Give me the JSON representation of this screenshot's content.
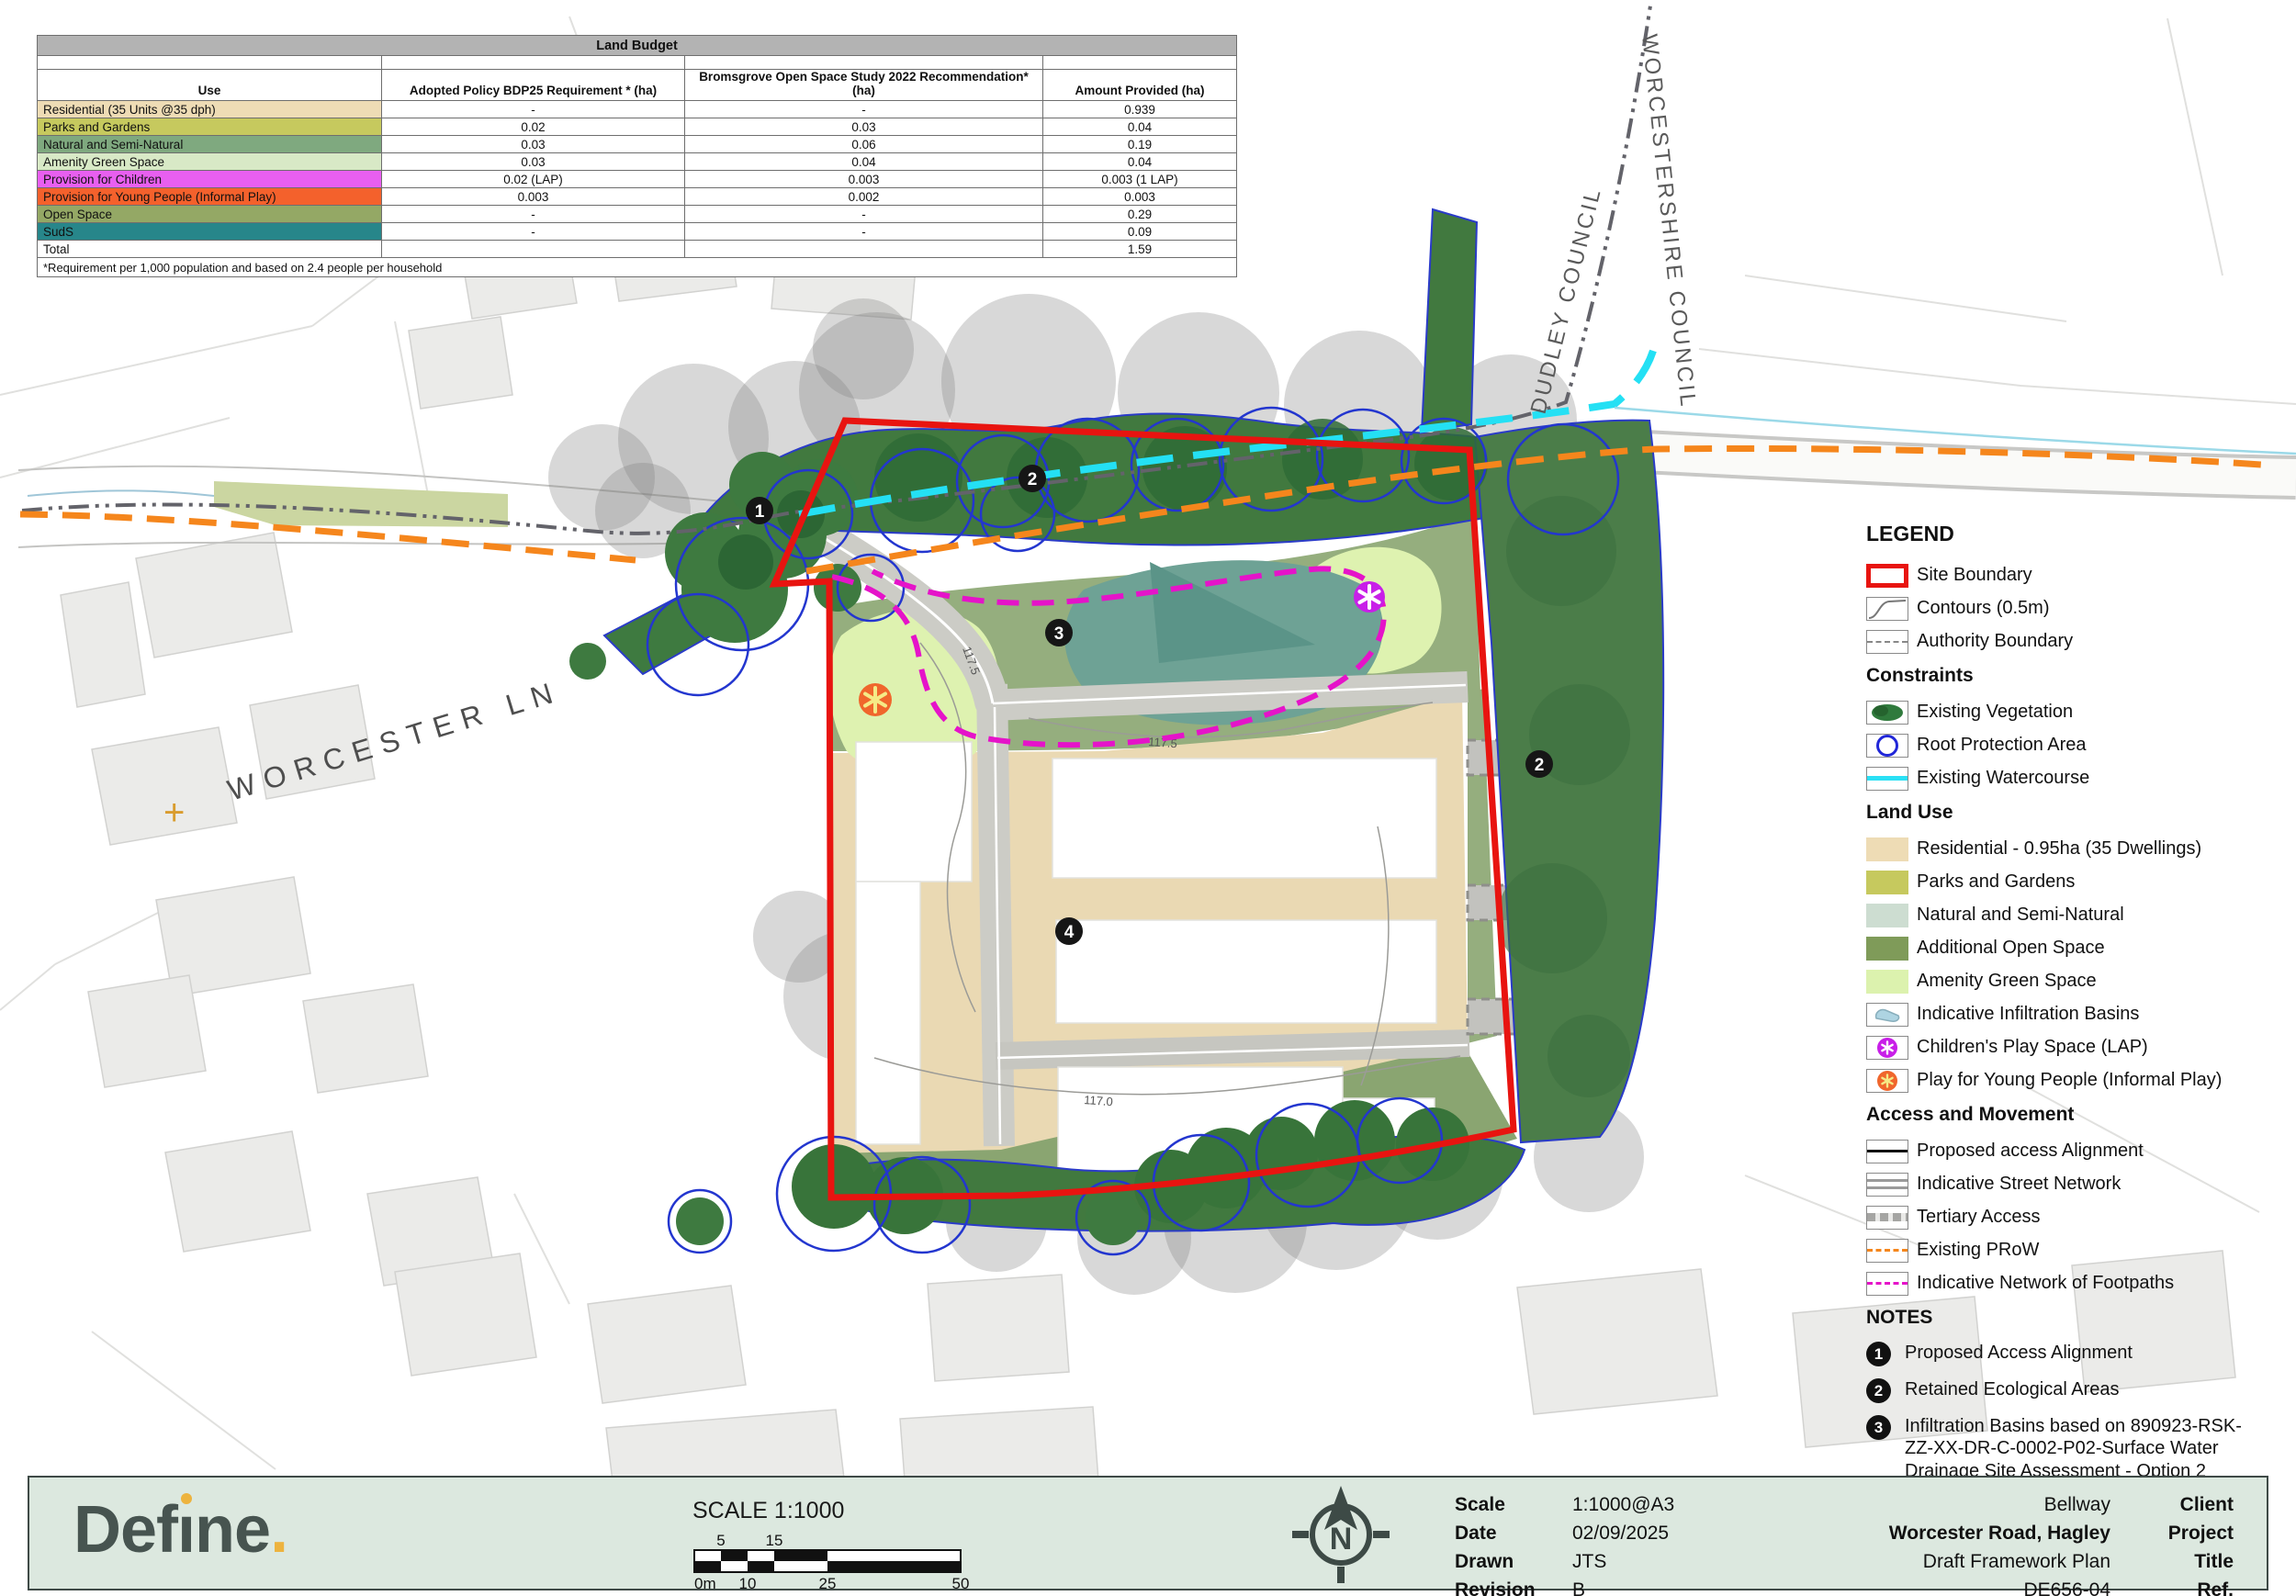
{
  "table": {
    "title": "Land Budget",
    "columns": [
      "Use",
      "Adopted Policy BDP25 Requirement * (ha)",
      "Bromsgrove Open Space Study 2022 Recommendation* (ha)",
      "Amount Provided (ha)"
    ],
    "rows": [
      {
        "use": "Residential (35 Units @35 dph)",
        "bdp25": "-",
        "bross": "-",
        "provided": "0.939"
      },
      {
        "use": "Parks and Gardens",
        "bdp25": "0.02",
        "bross": "0.03",
        "provided": "0.04"
      },
      {
        "use": "Natural and Semi-Natural",
        "bdp25": "0.03",
        "bross": "0.06",
        "provided": "0.19"
      },
      {
        "use": "Amenity Green Space",
        "bdp25": "0.03",
        "bross": "0.04",
        "provided": "0.04"
      },
      {
        "use": "Provision for Children",
        "bdp25": "0.02 (LAP)",
        "bross": "0.003",
        "provided": "0.003 (1 LAP)"
      },
      {
        "use": "Provision for Young People (Informal Play)",
        "bdp25": "0.003",
        "bross": "0.002",
        "provided": "0.003"
      },
      {
        "use": "Open Space",
        "bdp25": "-",
        "bross": "-",
        "provided": "0.29"
      },
      {
        "use": "SudS",
        "bdp25": "-",
        "bross": "-",
        "provided": "0.09"
      },
      {
        "use": "Total",
        "bdp25": "",
        "bross": "",
        "provided": "1.59"
      }
    ],
    "footnote": "*Requirement per 1,000 population and based on 2.4 people per household"
  },
  "map": {
    "street_label": "WORCESTER LN",
    "authority_left": "DUDLEY COUNCIL",
    "authority_right": "WORCESTERSHIRE COUNCIL",
    "markers": [
      {
        "label": "1"
      },
      {
        "label": "2"
      },
      {
        "label": "3"
      },
      {
        "label": "4"
      },
      {
        "label": "2"
      }
    ],
    "contour_labels": [
      "117.5",
      "117.5",
      "117.0"
    ]
  },
  "legend": {
    "title": "LEGEND",
    "site_boundary": "Site Boundary",
    "contours": "Contours (0.5m)",
    "authority": "Authority Boundary",
    "constraints_header": "Constraints",
    "vegetation": "Existing Vegetation",
    "root": "Root Protection Area",
    "watercourse": "Existing Watercourse",
    "landuse_header": "Land Use",
    "residential": "Residential - 0.95ha (35 Dwellings)",
    "parks": "Parks and Gardens",
    "natural": "Natural and Semi-Natural",
    "additional": "Additional Open Space",
    "amenity": "Amenity Green Space",
    "basins": "Indicative Infiltration Basins",
    "lap": "Children's Play Space (LAP)",
    "informal": "Play for Young People (Informal Play)",
    "access_header": "Access and Movement",
    "access": "Proposed access Alignment",
    "street": "Indicative Street Network",
    "tertiary": "Tertiary Access",
    "prow": "Existing PRoW",
    "footpaths": "Indicative Network of Footpaths",
    "notes_header": "NOTES",
    "notes": [
      {
        "num": "1",
        "text": "Proposed Access Alignment"
      },
      {
        "num": "2",
        "text": "Retained Ecological Areas"
      },
      {
        "num": "3",
        "text": "Infiltration Basins based on 890923-RSK-ZZ-XX-DR-C-0002-P02-Surface Water Drainage Site Assessment - Option 2 Discharge to Watercourse"
      },
      {
        "num": "4",
        "text": "Indicative Block Frontages"
      }
    ]
  },
  "footer": {
    "logo_prefix": "Def",
    "logo_i": "ı",
    "logo_suffix": "ne",
    "logo_period": ".",
    "scale_heading": "SCALE 1:1000",
    "scalebar": {
      "top_labels": [
        "5",
        "15"
      ],
      "bottom_labels": [
        "0m",
        "10",
        "25",
        "50"
      ]
    },
    "north_letter": "N",
    "info": [
      {
        "label": "Scale",
        "value": "1:1000@A3"
      },
      {
        "label": "Date",
        "value": "02/09/2025"
      },
      {
        "label": "Drawn",
        "value": "JTS"
      },
      {
        "label": "Revision",
        "value": "B"
      }
    ],
    "project": [
      {
        "value": "Bellway",
        "label": "Client"
      },
      {
        "value": "Worcester Road, Hagley",
        "label": "Project"
      },
      {
        "value": "Draft Framework Plan",
        "label": "Title"
      },
      {
        "value": "DE656-04",
        "label": "Ref."
      }
    ]
  },
  "colors": {
    "site_boundary": "#e81410",
    "prow": "#f5861c",
    "watercourse": "#24e0f4",
    "footpath": "#e513c9",
    "vegetation": "#41793f",
    "root_protection": "#2336cf",
    "residential": "#eedcb5",
    "parks_and_gardens": "#c6c95e",
    "natural_semi_natural_legend": "#cdddd1",
    "natural_semi_natural_table": "#7fa97f",
    "additional_open_space": "#7f9b59",
    "amenity_green_space": "#dcf2ae",
    "infiltration_basin": "#aed4e2",
    "childrens_play": "#c81fe8",
    "informal_play": "#f0662c",
    "open_space_row": "#94a865",
    "suds_row": "#27868a",
    "footer_bg": "#dce8df",
    "logo_text": "#475450",
    "logo_accent": "#edb33e"
  }
}
